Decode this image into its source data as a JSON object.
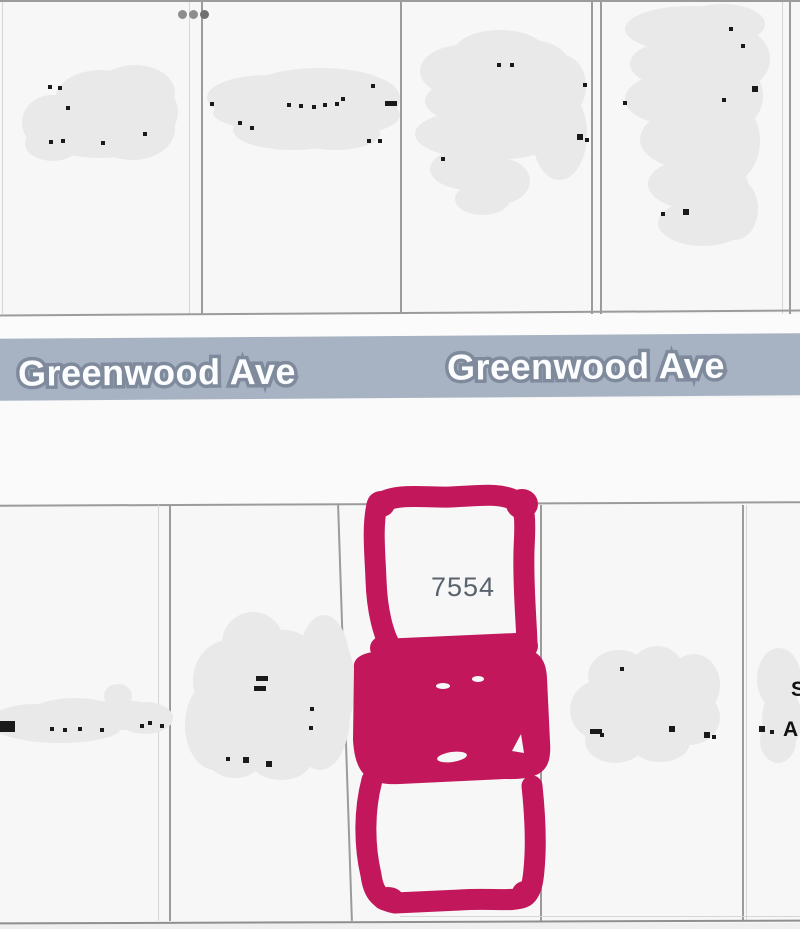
{
  "street": {
    "name_left": "Greenwood Ave",
    "name_right": "Greenwood Ave",
    "band_color": "#a7b3c3"
  },
  "parcel": {
    "number": "7554",
    "highlight_color": "#c2185b"
  },
  "fragments": {
    "letter_s": "S",
    "letter_a": "A"
  }
}
